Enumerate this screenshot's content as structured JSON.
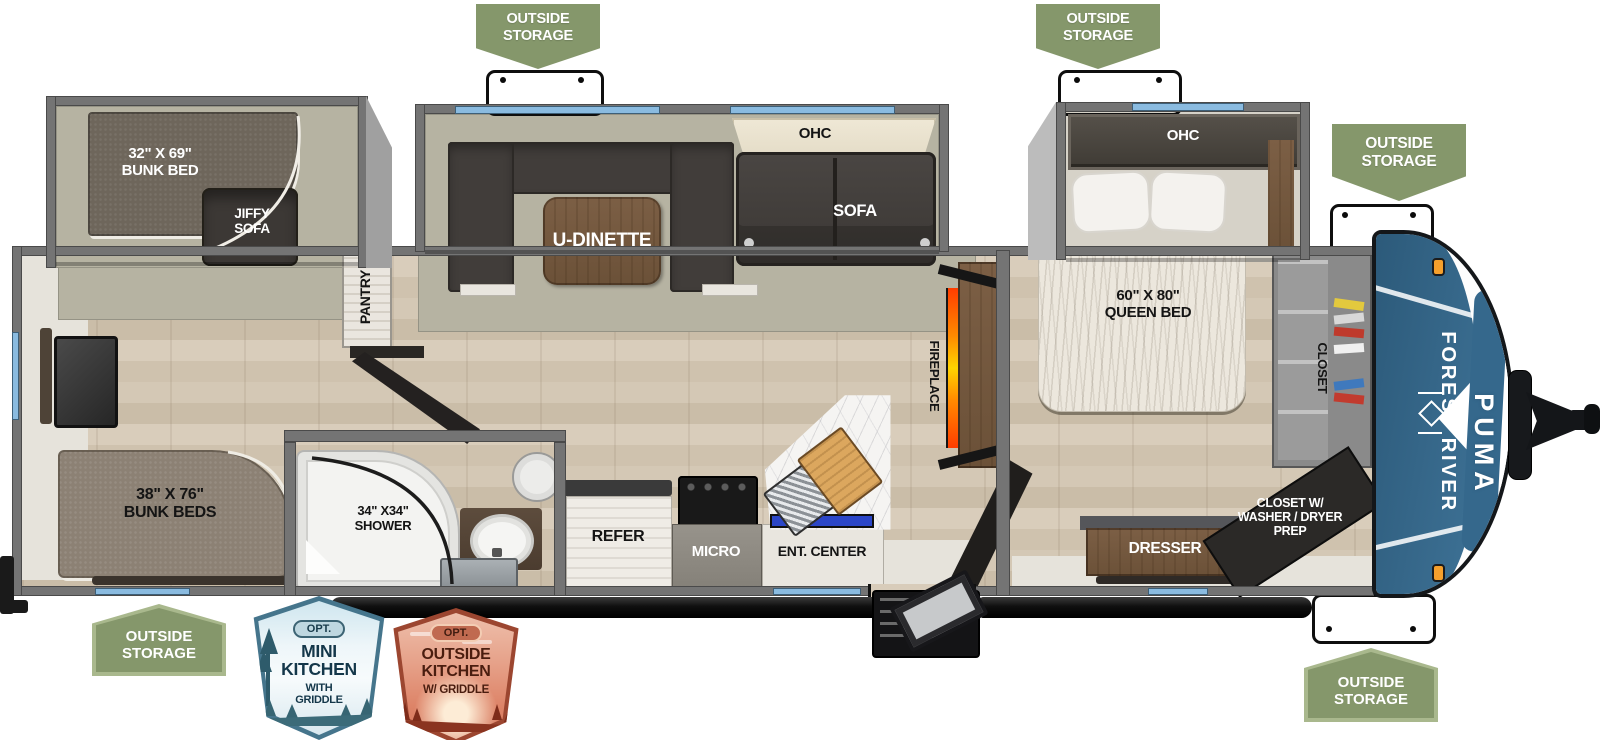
{
  "badges": {
    "outside_storage": "OUTSIDE\nSTORAGE",
    "opt": "OPT.",
    "mini_kitchen": {
      "title": "MINI\nKITCHEN",
      "subtitle": "WITH\nGRIDDLE"
    },
    "outside_kitchen": {
      "title": "OUTSIDE\nKITCHEN",
      "subtitle": "W/ GRIDDLE"
    }
  },
  "labels": {
    "bunk_bed_32x69": "32\" X 69\"\nBUNK BED",
    "jiffy_sofa": "JIFFY\nSOFA",
    "u_dinette": "U-DINETTE",
    "ohc_living": "OHC",
    "sofa": "SOFA",
    "pantry": "PANTRY",
    "bunk_beds_38x76": "38\" X 76\"\nBUNK BEDS",
    "shower_34x34": "34\" X34\"\nSHOWER",
    "refer": "REFER",
    "micro": "MICRO",
    "ent_center": "ENT. CENTER",
    "fireplace": "FIREPLACE",
    "ohc_bedroom": "OHC",
    "queen_bed_60x80": "60\" X 80\"\nQUEEN BED",
    "dresser": "DRESSER",
    "closet": "CLOSET",
    "closet_washer_dryer": "CLOSET W/\nWASHER / DRYER\nPREP"
  },
  "brand": {
    "manufacturer": "FOREST RIVER",
    "model": "PUMA"
  },
  "colors": {
    "badge_green": "#85976b",
    "badge_green_border": "#a9b88d",
    "cap_blue": "#35688c",
    "window_blue": "#8abbe0",
    "flame_orange": "#ff8a00",
    "tv_blue": "#2b46c8",
    "wall_gray": "#747474",
    "mini_badge_blue": "#45758c",
    "outside_badge_red": "#9c4630"
  }
}
